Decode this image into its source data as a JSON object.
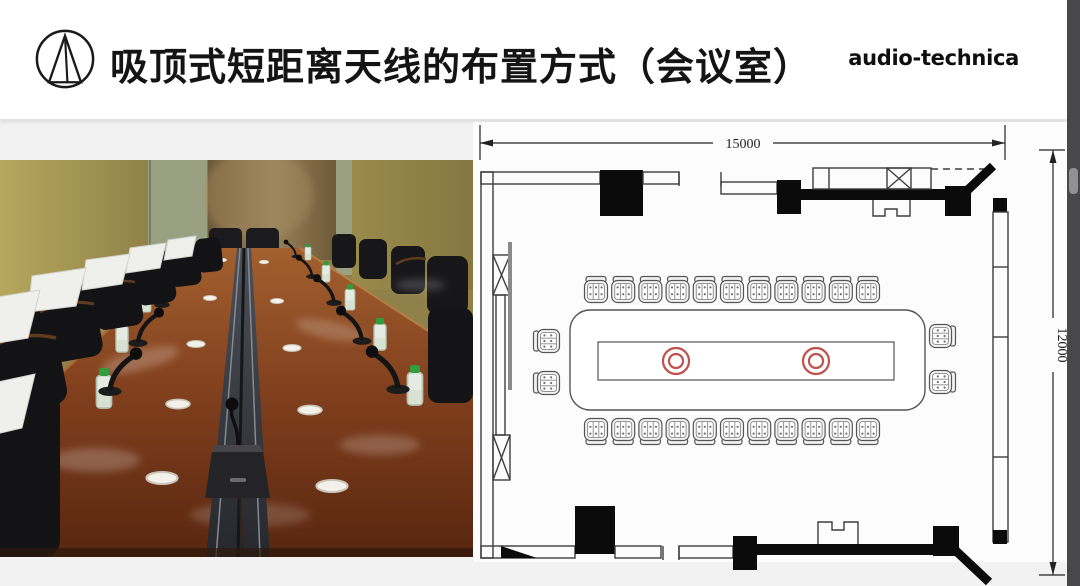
{
  "header": {
    "title": "吸顶式短距离天线的布置方式（会议室）",
    "brand_wordmark": "audio-technica"
  },
  "floor_plan": {
    "width_label": "15000",
    "height_label": "12000",
    "antennas": {
      "count": 2,
      "color": "#c0504d"
    },
    "chairs": {
      "top": 11,
      "bottom": 11,
      "left_end": 2,
      "right_end": 2
    }
  },
  "colors": {
    "header_bg": "#ffffff",
    "content_bg": "#f2f2f3",
    "plan_bg": "#fcfcfc",
    "plan_line": "#3c3c3c",
    "plan_fill_black": "#0b0b0b",
    "antenna_red": "#c0504d",
    "scrollbar_track": "#48484b",
    "scrollbar_thumb": "#919194"
  }
}
